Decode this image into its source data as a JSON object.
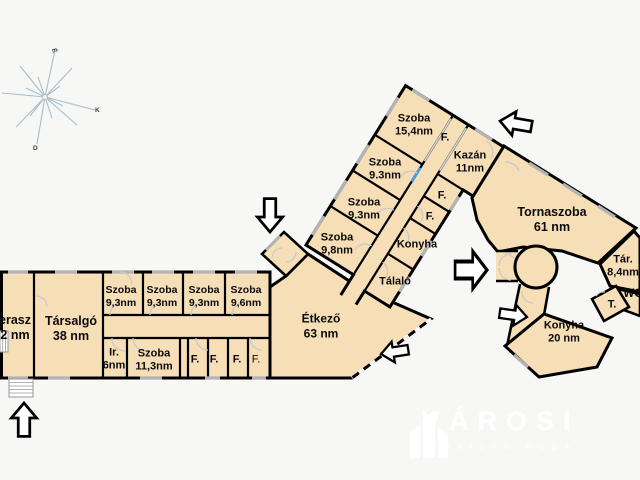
{
  "colors": {
    "room_fill": "#f6deb7",
    "wall": "#000000",
    "door_arc": "#c9c9c9",
    "window_mark": "#b3b3b3",
    "background": "#f7f7f5",
    "logo_white": "#ffffff",
    "corridor_door_blue": "#4aa0dc",
    "compass_line": "#a9bdc9"
  },
  "compass": {
    "north": "É",
    "east": "K",
    "south": "D"
  },
  "rooms": {
    "terasz": {
      "line1": "erasz",
      "line2": "2 nm"
    },
    "tarsalgo": {
      "line1": "Társalgó",
      "line2": "38 nm"
    },
    "szoba_a1": {
      "line1": "Szoba",
      "line2": "9,3nm"
    },
    "szoba_a2": {
      "line1": "Szoba",
      "line2": "9,3nm"
    },
    "szoba_a3": {
      "line1": "Szoba",
      "line2": "9,3nm"
    },
    "szoba_a4": {
      "line1": "Szoba",
      "line2": "9,6nm"
    },
    "iroda": {
      "line1": "Ir.",
      "line2": "6nm"
    },
    "szoba_b": {
      "line1": "Szoba",
      "line2": "11,3nm"
    },
    "f1": {
      "line1": "F."
    },
    "f2": {
      "line1": "F."
    },
    "f3": {
      "line1": "F."
    },
    "f4": {
      "line1": "F."
    },
    "etkezo": {
      "line1": "Étkező",
      "line2": "63 nm"
    },
    "szoba_15": {
      "line1": "Szoba",
      "line2": "15,4nm"
    },
    "f_top": {
      "line1": "F."
    },
    "kazan": {
      "line1": "Kazán",
      "line2": "11nm"
    },
    "szoba_93a": {
      "line1": "Szoba",
      "line2": "9.3nm"
    },
    "szoba_93b": {
      "line1": "Szoba",
      "line2": "9.3nm"
    },
    "szoba_98": {
      "line1": "Szoba",
      "line2": "9,8nm"
    },
    "f_w1": {
      "line1": "F."
    },
    "f_w2": {
      "line1": "F."
    },
    "konyha_wing": {
      "line1": "Konyha"
    },
    "talalo": {
      "line1": "Tálaló"
    },
    "tornaszoba": {
      "line1": "Tornaszoba",
      "line2": "61 nm"
    },
    "tar": {
      "line1": "Tár.",
      "line2": "8,4nm"
    },
    "wc": {
      "line1": "WC"
    },
    "t": {
      "line1": "T."
    },
    "konyha_20": {
      "line1": "Konyha",
      "line2": "20 nm"
    }
  },
  "logo": {
    "title": "VÁROSI",
    "subtitle": "INGATLANIRODA"
  }
}
